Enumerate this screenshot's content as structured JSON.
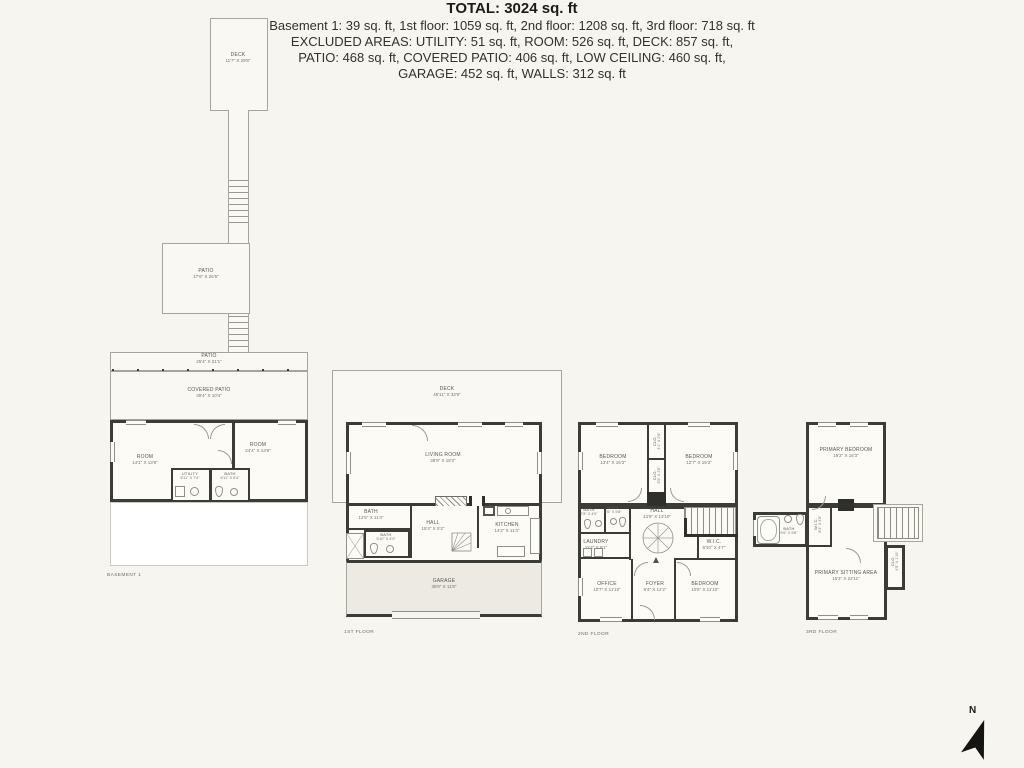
{
  "colors": {
    "background": "#f6f5ef",
    "wall": "#3b3b38",
    "thin_line": "#a6a59c",
    "room_fill": "#fcfbf6",
    "garage_fill": "#eceae2",
    "chimney_fill": "#2f2f2c",
    "text": "#32312c"
  },
  "plans": {
    "deck_top": {
      "name": "DECK",
      "dims": "11'7\" X 29'8\""
    },
    "patio_upper": {
      "name": "PATIO",
      "dims": "17'6\" X 26'5\""
    },
    "basement": {
      "floor_label": "BASEMENT 1",
      "patio": {
        "name": "PATIO",
        "dims": "25'4\" X 21'1\""
      },
      "covered_patio": {
        "name": "COVERED PATIO",
        "dims": "39'4\" X 10'4\""
      },
      "room_left": {
        "name": "ROOM",
        "dims": "14'1\" X 13'8\""
      },
      "room_right": {
        "name": "ROOM",
        "dims": "24'4\" X 13'8\""
      },
      "utility": {
        "name": "UTILITY",
        "dims": "6'11\" X 7'4\""
      },
      "bath": {
        "name": "BATH",
        "dims": "6'11\" X 6'4\""
      }
    },
    "floor1": {
      "floor_label": "1ST FLOOR",
      "deck": {
        "name": "DECK",
        "dims": "45'11\" X 32'9\""
      },
      "living_room": {
        "name": "LIVING ROOM",
        "dims": "38'9\" X 18'2\""
      },
      "bath": {
        "name": "BATH",
        "dims": "12'5\" X 11'4\""
      },
      "bath_small": {
        "name": "BATH",
        "dims": "5'10\" X 4'9\""
      },
      "hall": {
        "name": "HALL",
        "dims": "15'4\" X 5'2\""
      },
      "kitchen": {
        "name": "KITCHEN",
        "dims": "14'2\" X 11'4\""
      },
      "garage": {
        "name": "GARAGE",
        "dims": "38'9\" X 11'8\""
      }
    },
    "floor2": {
      "floor_label": "2ND FLOOR",
      "bedroom_left": {
        "name": "BEDROOM",
        "dims": "13'4\" X 16'3\""
      },
      "bedroom_right": {
        "name": "BEDROOM",
        "dims": "12'7\" X 16'3\""
      },
      "closet_top": {
        "name": "CLO.",
        "dims": "4'1\" X 2'6\""
      },
      "closet_bottom": {
        "name": "CLO.",
        "dims": "3'5\" X 2'6\""
      },
      "bath_left": {
        "name": "BATH",
        "dims": "7'8\" X 4'9\""
      },
      "bath_mid": {
        "name": "BATH",
        "dims": "5'6\" X 5'8\""
      },
      "laundry": {
        "name": "LAUNDRY",
        "dims": "11'4\" X 6'1\""
      },
      "hall": {
        "name": "HALL",
        "dims": "13'9\" X 13'10\""
      },
      "office": {
        "name": "OFFICE",
        "dims": "10'7\" X 11'10\""
      },
      "foyer": {
        "name": "FOYER",
        "dims": "8'4\" X 12'2\""
      },
      "wic": {
        "name": "W.I.C.",
        "dims": "5'10\" X 4'7\""
      },
      "bedroom_small": {
        "name": "BEDROOM",
        "dims": "10'6\" X 11'10\""
      }
    },
    "floor3": {
      "floor_label": "3RD FLOOR",
      "primary_bedroom": {
        "name": "PRIMARY BEDROOM",
        "dims": "19'2\" X 16'3\""
      },
      "bath": {
        "name": "BATH",
        "dims": "9'6\" X 5'8\""
      },
      "wic": {
        "name": "W.I.C.",
        "dims": "8'4\" X 4'5\""
      },
      "sitting": {
        "name": "PRIMARY SITTING AREA",
        "dims": "15'3\" X 22'11\""
      },
      "closet": {
        "name": "CLO.",
        "dims": "4'5\" X 1'10\""
      }
    }
  },
  "summary": {
    "total": "TOTAL: 3024 sq. ft",
    "line1": "Basement 1: 39 sq. ft, 1st floor: 1059 sq. ft, 2nd floor: 1208 sq. ft, 3rd floor: 718 sq. ft",
    "line2": "EXCLUDED AREAS: UTILITY: 51 sq. ft, ROOM: 526 sq. ft, DECK: 857 sq. ft,",
    "line3": "PATIO: 468 sq. ft, COVERED PATIO: 406 sq. ft, LOW CEILING: 460 sq. ft,",
    "line4": "GARAGE: 452 sq. ft, WALLS: 312 sq. ft"
  },
  "compass": {
    "label": "N"
  }
}
